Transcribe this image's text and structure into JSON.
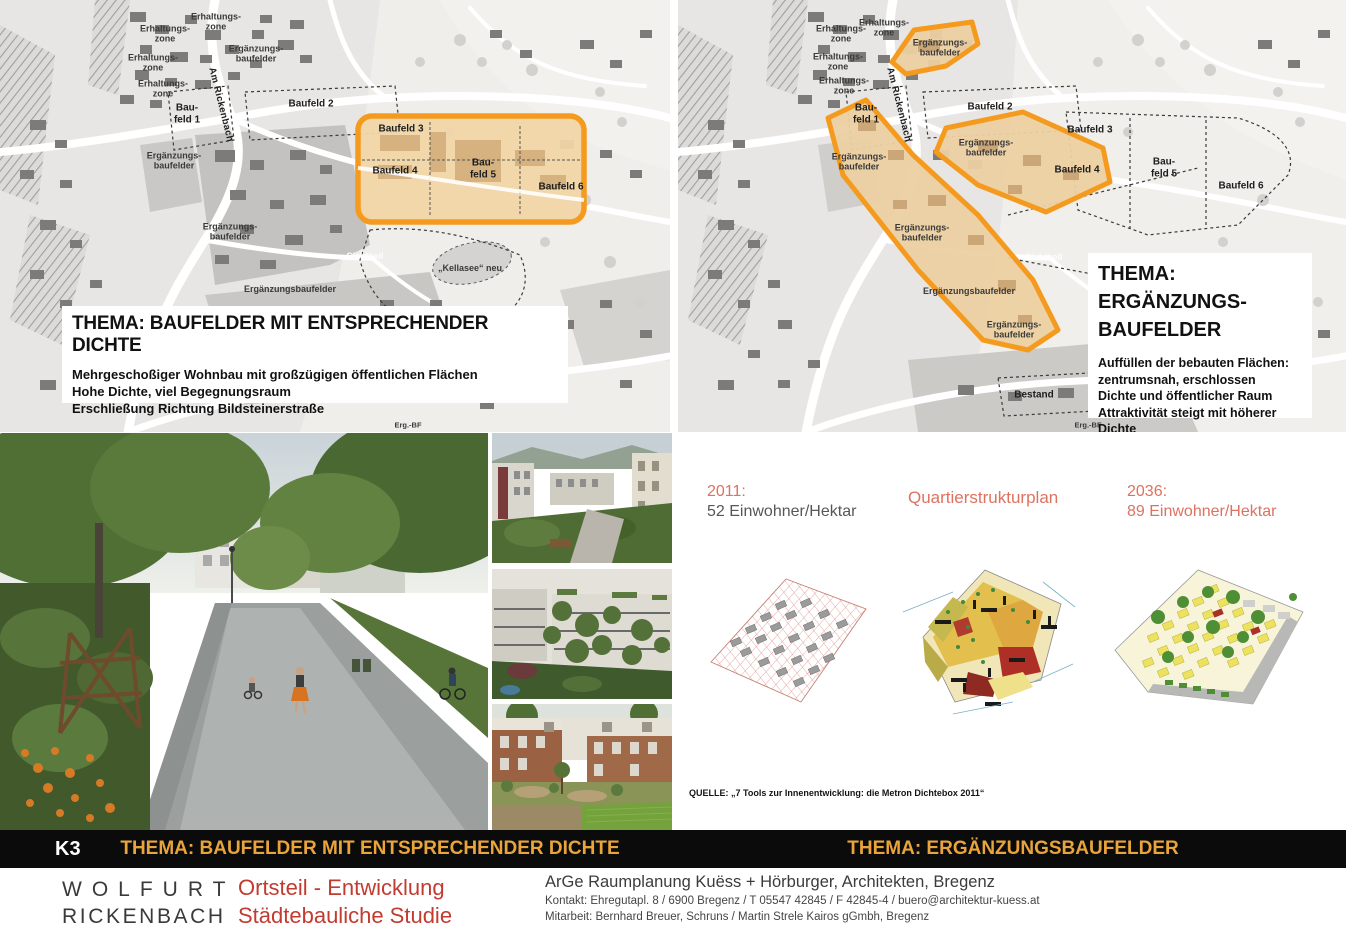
{
  "colors": {
    "highlight_orange": "#F49B1F",
    "tan_fill": "#F0D5A6",
    "bar_gold": "#E9A43B",
    "footer_red": "#C23B30",
    "salmon": "#DD7260",
    "bar_black": "#0B0B0B"
  },
  "map_left": {
    "labels": {
      "erh1": "Erhaltungs-\nzone",
      "erh2": "Erhaltungs-\nzone",
      "erh3": "Erhaltungs-\nzone",
      "erh4": "Erhaltungs-\nzone",
      "erg_top": "Ergänzungs-\nbaufelder",
      "street": "Am Rickenbach",
      "bf1": "Bau-\nfeld 1",
      "bf2": "Baufeld 2",
      "bf3": "Baufeld 3",
      "bf4": "Baufeld 4",
      "bf5": "Bau-\nfeld 5",
      "bf6": "Baufeld 6",
      "erg_left": "Ergänzungs-\nbaufelder",
      "erg_mid": "Ergänzungs-\nbaufelder",
      "erg_bottom": "Ergänzungsbaufelder",
      "sichtkeil": "Sichtkeil",
      "kellasee": "„Kellasee“ neu",
      "erg_bf_edge": "Erg.-BF"
    },
    "infobox": {
      "title": "THEMA: BAUFELDER MIT ENTSPRECHENDER DICHTE",
      "lines": [
        "Mehrgeschoßiger Wohnbau mit großzügigen öffentlichen Flächen",
        "Hohe Dichte, viel Begegnungsraum",
        "Erschließung Richtung Bildsteinerstraße"
      ]
    }
  },
  "map_right": {
    "labels": {
      "erh1": "Erhaltungs-\nzone",
      "erh2": "Erhaltungs-\nzone",
      "erh3": "Erhaltungs-\nzone",
      "erh4": "Erhaltungs-\nzone",
      "erg_poly_top": "Ergänzungs-\nbaufelder",
      "street": "Am Rickenbach",
      "bf1": "Bau-\nfeld 1",
      "bf2": "Baufeld 2",
      "bf3": "Baufeld 3",
      "bf4": "Baufeld 4",
      "bf5": "Bau-\nfeld 5",
      "bf6": "Baufeld 6",
      "erg_poly_left": "Ergänzungs-\nbaufelder",
      "erg_poly_mid": "Ergänzungs-\nbaufelder",
      "erg_mid2": "Ergänzungs-\nbaufelder",
      "erg_line": "Ergänzungsbaufelder",
      "erg_poly_bottom": "Ergänzungs-\nbaufelder",
      "sichtkeil": "Sichtkeil",
      "bestand": "Bestand",
      "erg_bf_edge": "Erg.-BF"
    },
    "infobox": {
      "title_line1": "THEMA:",
      "title_line2": "ERGÄNZUNGS-",
      "title_line3": "BAUFELDER",
      "lines": [
        "Auffüllen der bebauten Flächen:",
        "zentrumsnah, erschlossen",
        "Dichte und öffentlicher Raum",
        "Attraktivität steigt mit höherer Dichte"
      ]
    }
  },
  "diagrams": {
    "y2011_label": "2011:",
    "y2011_value": "52 Einwohner/Hektar",
    "center_label": "Quartierstrukturplan",
    "y2036_label": "2036:",
    "y2036_value": "89 Einwohner/Hektar",
    "source": "QUELLE: „7 Tools zur Innenentwicklung: die Metron Dichtebox 2011“"
  },
  "titlebar": {
    "code": "K3",
    "left_title": "THEMA: BAUFELDER MIT ENTSPRECHENDER DICHTE",
    "right_title": "THEMA: ERGÄNZUNGSBAUFELDER"
  },
  "footer": {
    "org_line1": "WOLFURT",
    "org_line2": "RICKENBACH",
    "proj_line1": "Ortsteil - Entwicklung",
    "proj_line2": "Städtebauliche Studie",
    "firm": "ArGe Raumplanung Kuëss + Hörburger, Architekten, Bregenz",
    "contact": "Kontakt: Ehregutapl. 8 / 6900 Bregenz  / T 05547 42845 / F 42845-4 / buero@architektur-kuess.at",
    "team": "Mitarbeit: Bernhard Breuer, Schruns / Martin Strele Kairos gGmbh, Bregenz"
  }
}
